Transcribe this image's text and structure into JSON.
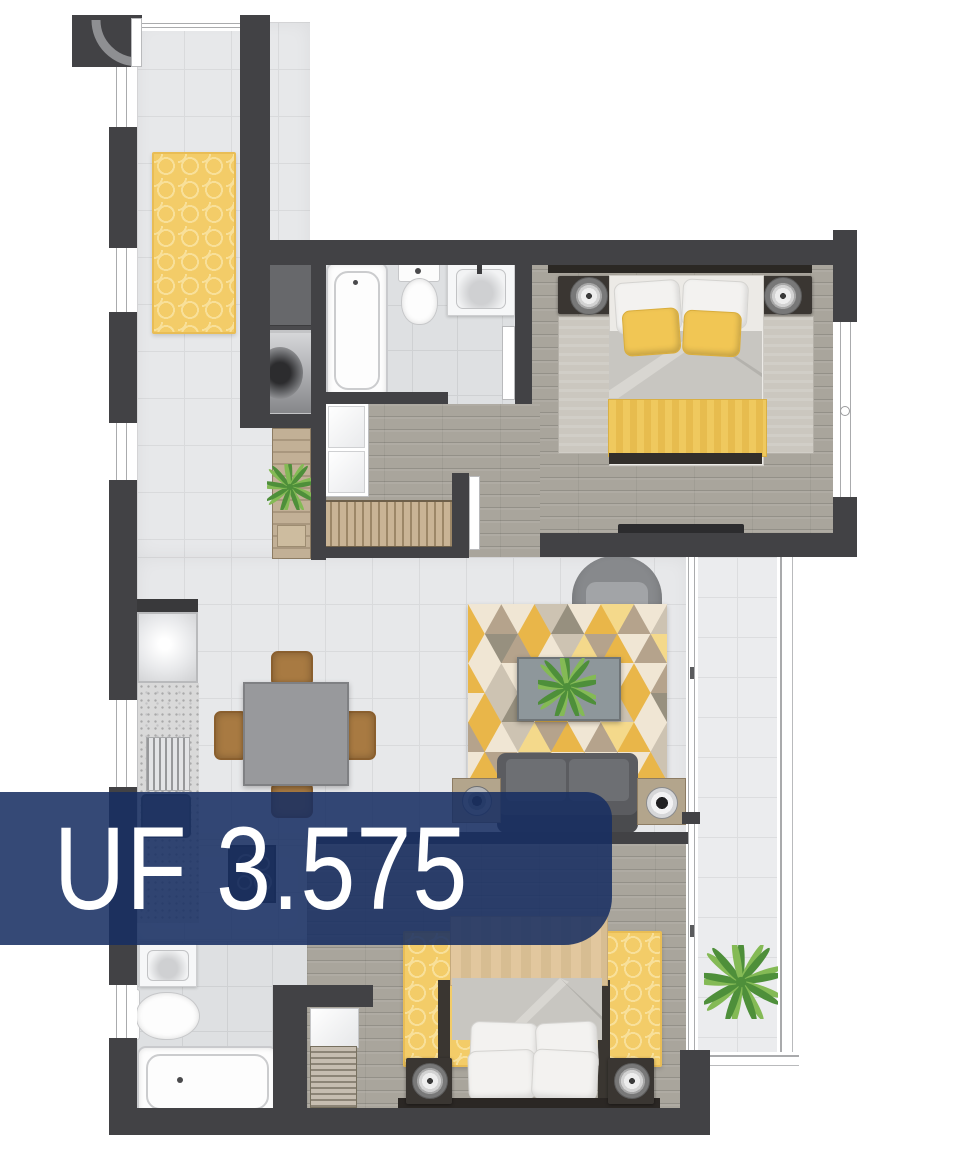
{
  "banner": {
    "label": "UF 3.575"
  },
  "colors": {
    "wall": "#424245",
    "wall_inner": "#4a4a4d",
    "closet_gray": "#67686b",
    "floor_tile": "#e7e8ea",
    "tile_line": "#d9dadc",
    "bath_tile": "#dee0e2",
    "bath_tile_line": "#cfd1d3",
    "balcony_tile": "#ebecee",
    "balcony_tile_line": "#dcdddf",
    "floor_wood": "#a9a59c",
    "glass_line": "#aaabad",
    "rug_yellow": "#f3cc68",
    "rug_yellow_lattice": "#f8e09a",
    "rug_yellow_edge": "#e9bd55",
    "bed_rug_gray": "#cbc7bf",
    "accent_yellow": "#f1c654",
    "throw_yellow": "#efc95e",
    "blanket_tan": "#e2c79e",
    "duvet_gray": "#c8c6c1",
    "sheet_white": "#eceae6",
    "bedframe_dark": "#332f2b",
    "sofa_gray": "#5b5c60",
    "cushion_gray": "#6d6f73",
    "armchair_gray": "#87898c",
    "seat_gray": "#a2a4a7",
    "table_gray": "#98999c",
    "coffee_table": "#8e979b",
    "side_table_wood": "#b3a58c",
    "chair_wood": "#a87a42",
    "counter": "#d9d9d9",
    "appliance_dark": "#3a3a3c",
    "banner_bg": "rgba(23,46,98,0.87)",
    "banner_text": "#ffffff",
    "plant_dark": "#4e8f3a",
    "plant_light": "#84ba55"
  },
  "living_room": {
    "triangle_rug": {
      "rows": 6,
      "cols": 6,
      "palette": [
        "#e9b649",
        "#f0e6d4",
        "#b5a38c",
        "#cdc3b2",
        "#97907f",
        "#f4d98b"
      ],
      "sequence": [
        0,
        1,
        2,
        1,
        0,
        3,
        4,
        1,
        0,
        5,
        2,
        1,
        3,
        0,
        1,
        4,
        2,
        0,
        1,
        3,
        5,
        2,
        0,
        1,
        2,
        5,
        0,
        1,
        3,
        1,
        0,
        2,
        1,
        4,
        0,
        1
      ]
    }
  }
}
